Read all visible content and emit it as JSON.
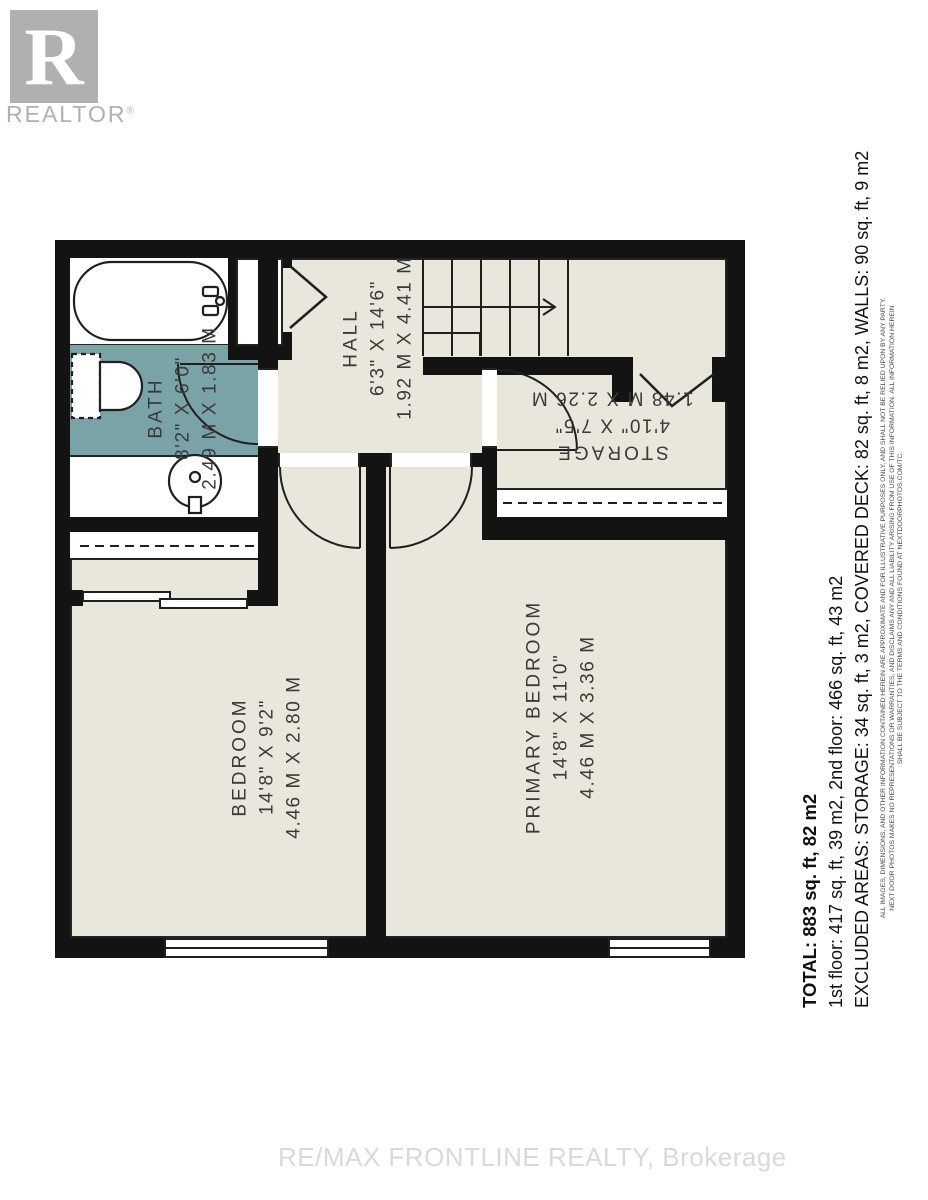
{
  "logo": {
    "letter": "R",
    "brand": "REALTOR",
    "registered": "®"
  },
  "plan": {
    "rooms": [
      {
        "name": "BATH",
        "imperial": "8'2\" X 6'0\"",
        "metric": "2.49 M X 1.83 M"
      },
      {
        "name": "HALL",
        "imperial": "6'3\" X 14'6\"",
        "metric": "1.92 M X 4.41 M"
      },
      {
        "name": "STORAGE",
        "imperial": "4'10\" X 7'5\"",
        "metric": "1.48 M X 2.26 M"
      },
      {
        "name": "BEDROOM",
        "imperial": "14'8\" X 9'2\"",
        "metric": "4.46 M X 2.80 M"
      },
      {
        "name": "PRIMARY BEDROOM",
        "imperial": "14'8\" X 11'0\"",
        "metric": "4.46 M X 3.36 M"
      }
    ],
    "icons": [
      "bathtub-icon",
      "toilet-icon",
      "sink-icon",
      "stairs-up-arrow-icon"
    ]
  },
  "summary": {
    "total": "TOTAL: 883 sq. ft, 82 m2",
    "floors": "1st floor: 417 sq. ft, 39 m2, 2nd floor: 466 sq. ft, 43 m2",
    "excluded": "EXCLUDED AREAS: STORAGE: 34 sq. ft, 3 m2, COVERED DECK: 82 sq. ft, 8 m2, WALLS: 90 sq. ft, 9 m2",
    "disclaimer": [
      "ALL IMAGES, DIMENSIONS, AND OTHER INFORMATION CONTAINED HEREIN ARE APPROXIMATE AND FOR ILLUSTRATIVE PURPOSES ONLY, AND SHALL NOT BE RELIED UPON BY ANY PARTY.",
      "NEXT DOOR PHOTOS MAKES NO REPRESENTATIONS OR WARRANTIES, AND DISCLAIMS ANY AND ALL LIABILITY ARISING FROM USE OF THIS INFORMATION. ALL INFORMATION HEREIN",
      "SHALL BE SUBJECT TO THE TERMS AND CONDITIONS FOUND AT NEXTDOORPHOTOS.COM/TC."
    ]
  },
  "watermark": "RE/MAX FRONTLINE REALTY, Brokerage",
  "colors": {
    "floor": "#e9e7dc",
    "bath_floor": "#7aa3a8",
    "wall": "#131313",
    "line": "#1f1f1f",
    "label_text": "#3a3a3a",
    "logo_gray": "#b0b0b0",
    "watermark_gray": "#d9d9d9"
  }
}
